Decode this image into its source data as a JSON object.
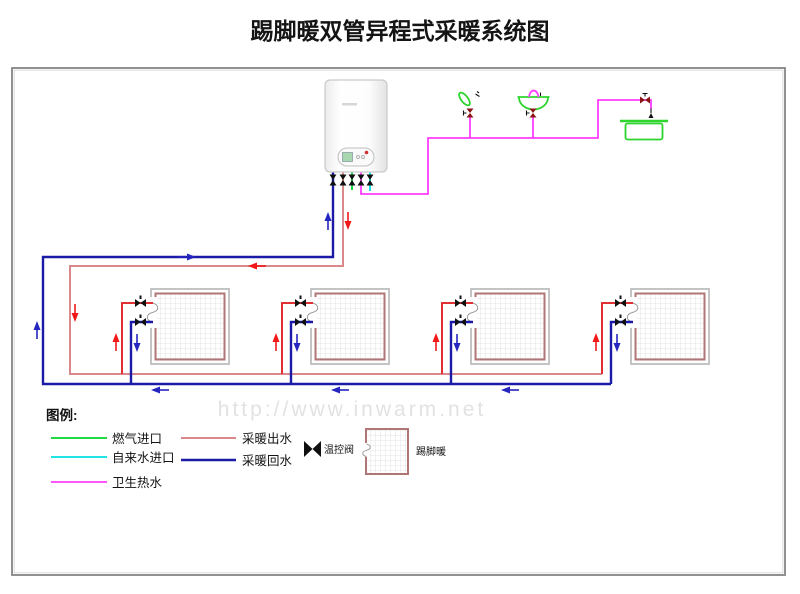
{
  "title": "踢脚暖双管异程式采暖系统图",
  "watermark": "http://www.inwarm.net",
  "colors": {
    "gas": "#00d42a",
    "tap_water": "#00e0e0",
    "hot_water": "#ff3dff",
    "supply_main": "#d98989",
    "supply": "#e03030",
    "return": "#1b1ba8",
    "arrow_red": "#f01818",
    "arrow_blue": "#2525c0",
    "panel_border": "#b07575",
    "panel_outer": "#c4c4c4",
    "grid_line": "#dcdcdc",
    "valve_black": "#101010",
    "valve_dark_red": "#8b1515",
    "fixture_green": "#2ed52e",
    "frame": "#858585",
    "watermark_color": "#e2e2e2"
  },
  "legend": {
    "heading": "图例:",
    "items": [
      {
        "label": "燃气进口",
        "color_key": "gas"
      },
      {
        "label": "自来水进口",
        "color_key": "tap_water"
      },
      {
        "label": "卫生热水",
        "color_key": "hot_water"
      },
      {
        "label": "采暖出水",
        "color_key": "supply_main"
      },
      {
        "label": "采暖回水",
        "color_key": "return"
      },
      {
        "label": "温控阀",
        "icon": "thermostatic-valve"
      },
      {
        "label": "踢脚暖",
        "icon": "skirting-heater-grid"
      }
    ]
  }
}
